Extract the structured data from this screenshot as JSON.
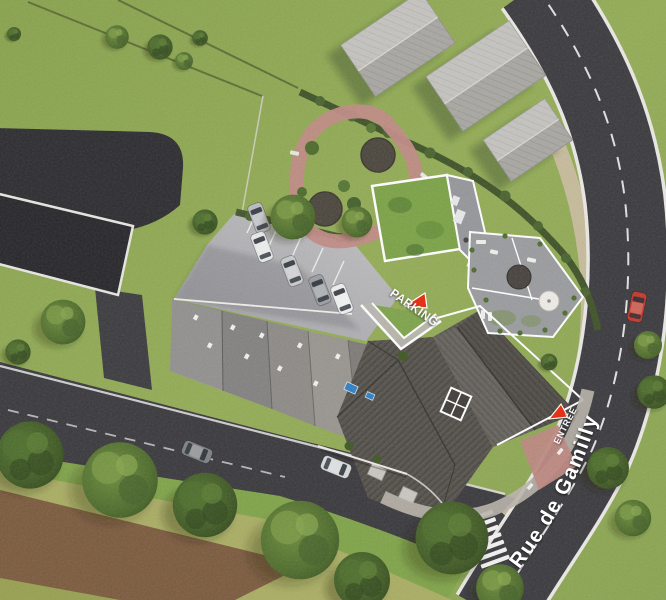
{
  "scene": {
    "description": "Aerial 3D architectural site plan rendering of a residential development",
    "street_label": "Rue de Gamilly",
    "parking_label": "PARKING",
    "entrance_label": "ENTRÉE",
    "markers": {
      "parking": {
        "label": "PARKING",
        "shape": "red-triangle"
      },
      "entrance": {
        "label": "ENTRÉE",
        "shape": "red-triangle"
      }
    },
    "colors": {
      "grass": "#8fa957",
      "road_asphalt": "#3a393d",
      "roof_dark": "#56524d",
      "roof_light": "#b6b3ae",
      "green_roof": "#7ba246",
      "garden_path_pink": "#c08a84",
      "marker_red": "#e23318",
      "dirt_brown": "#7b5a3d",
      "sidewalk_tan": "#c9bc9e",
      "label_text": "#ffffff"
    },
    "vehicles": {
      "parking_lot_cars": 5,
      "street_parked_cars": 2,
      "cars_on_main_road": 1,
      "main_road_car_color": "red"
    }
  }
}
